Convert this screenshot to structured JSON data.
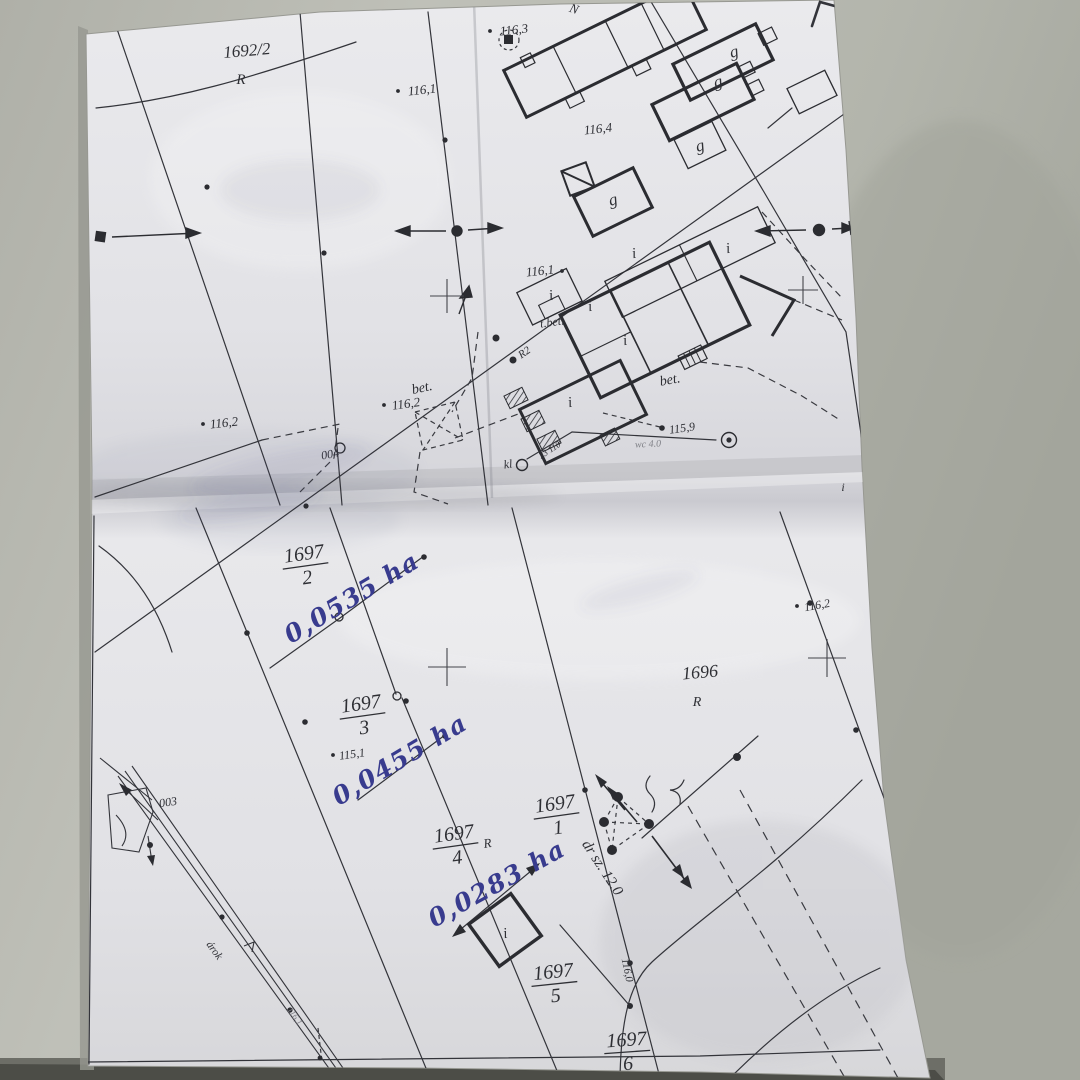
{
  "colors": {
    "wall": "#bdbfb6",
    "paper": "#e9e9ec",
    "ink": "#34353b",
    "handwriting_ink": "#3a3d91"
  },
  "labels": {
    "parcel_1692_2": "1692/2",
    "parcel_1696": "1696",
    "r": "R",
    "r2": "R2",
    "g": "g",
    "i": "i",
    "n": "N",
    "f1697": "1697",
    "den1": "1",
    "den2": "2",
    "den3": "3",
    "den4": "4",
    "den5": "5",
    "den6": "6",
    "v116_0": "116,0",
    "v116_1": "116,1",
    "v116_2": "116,2",
    "v116_3": "116,3",
    "v116_4": "116,4",
    "v115_1": "115,1",
    "v115_9": "115,9",
    "pt004": "004",
    "pt003": "003",
    "bet": "bet.",
    "t_bet": "t.bet.",
    "kl": "kl",
    "kl_num": "23 110",
    "wc": "wc 4.0",
    "road_width": "dr sz. 12.0",
    "ditch": "árok",
    "area_1697_2": "0,0535 ha",
    "area_1697_3": "0,0455 ha",
    "area_1697_4": "0,0283 ha"
  }
}
